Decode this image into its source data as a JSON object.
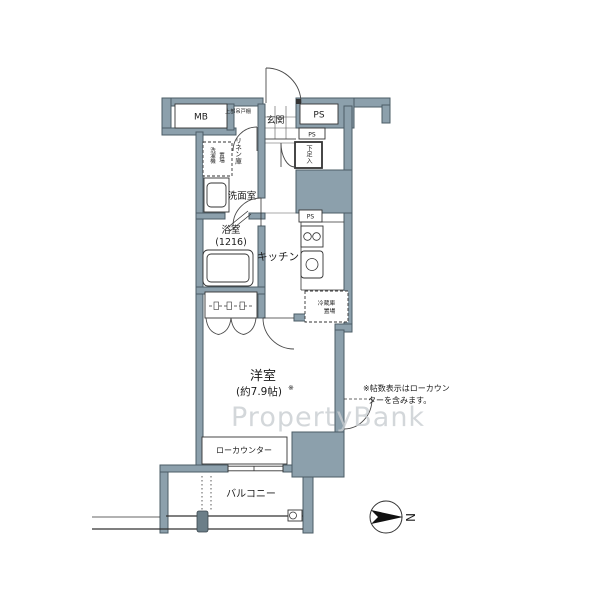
{
  "labels": {
    "mb": "MB",
    "ps_top": "PS",
    "ps_mid": "PS",
    "ps_kitchen": "PS",
    "genkan": "玄関",
    "upper_cabinet": "上部吊戸棚",
    "linen": "リネン庫",
    "washer_col1": "洗濯機",
    "washer_col2": "置場",
    "shoe_cabinet": "下足入",
    "washroom": "洗面室",
    "bath_line1": "浴室",
    "bath_line2": "(1216)",
    "kitchen": "キッチン",
    "fridge_line1": "冷蔵庫",
    "fridge_line2": "置場",
    "room_line1": "洋室",
    "room_line2": "(約7.9帖)",
    "area_note_mark": "※",
    "low_counter": "ローカウンター",
    "balcony": "バルコニー",
    "note_line1": "※帖数表示はローカウン",
    "note_line2": "ターを含みます。",
    "compass_north": "N",
    "watermark": "PropertyBank"
  },
  "colors": {
    "wall_fill": "#8ca0ac",
    "wall_stroke": "#4b5c66",
    "line": "#333333",
    "watermark": "#c9ced2"
  }
}
